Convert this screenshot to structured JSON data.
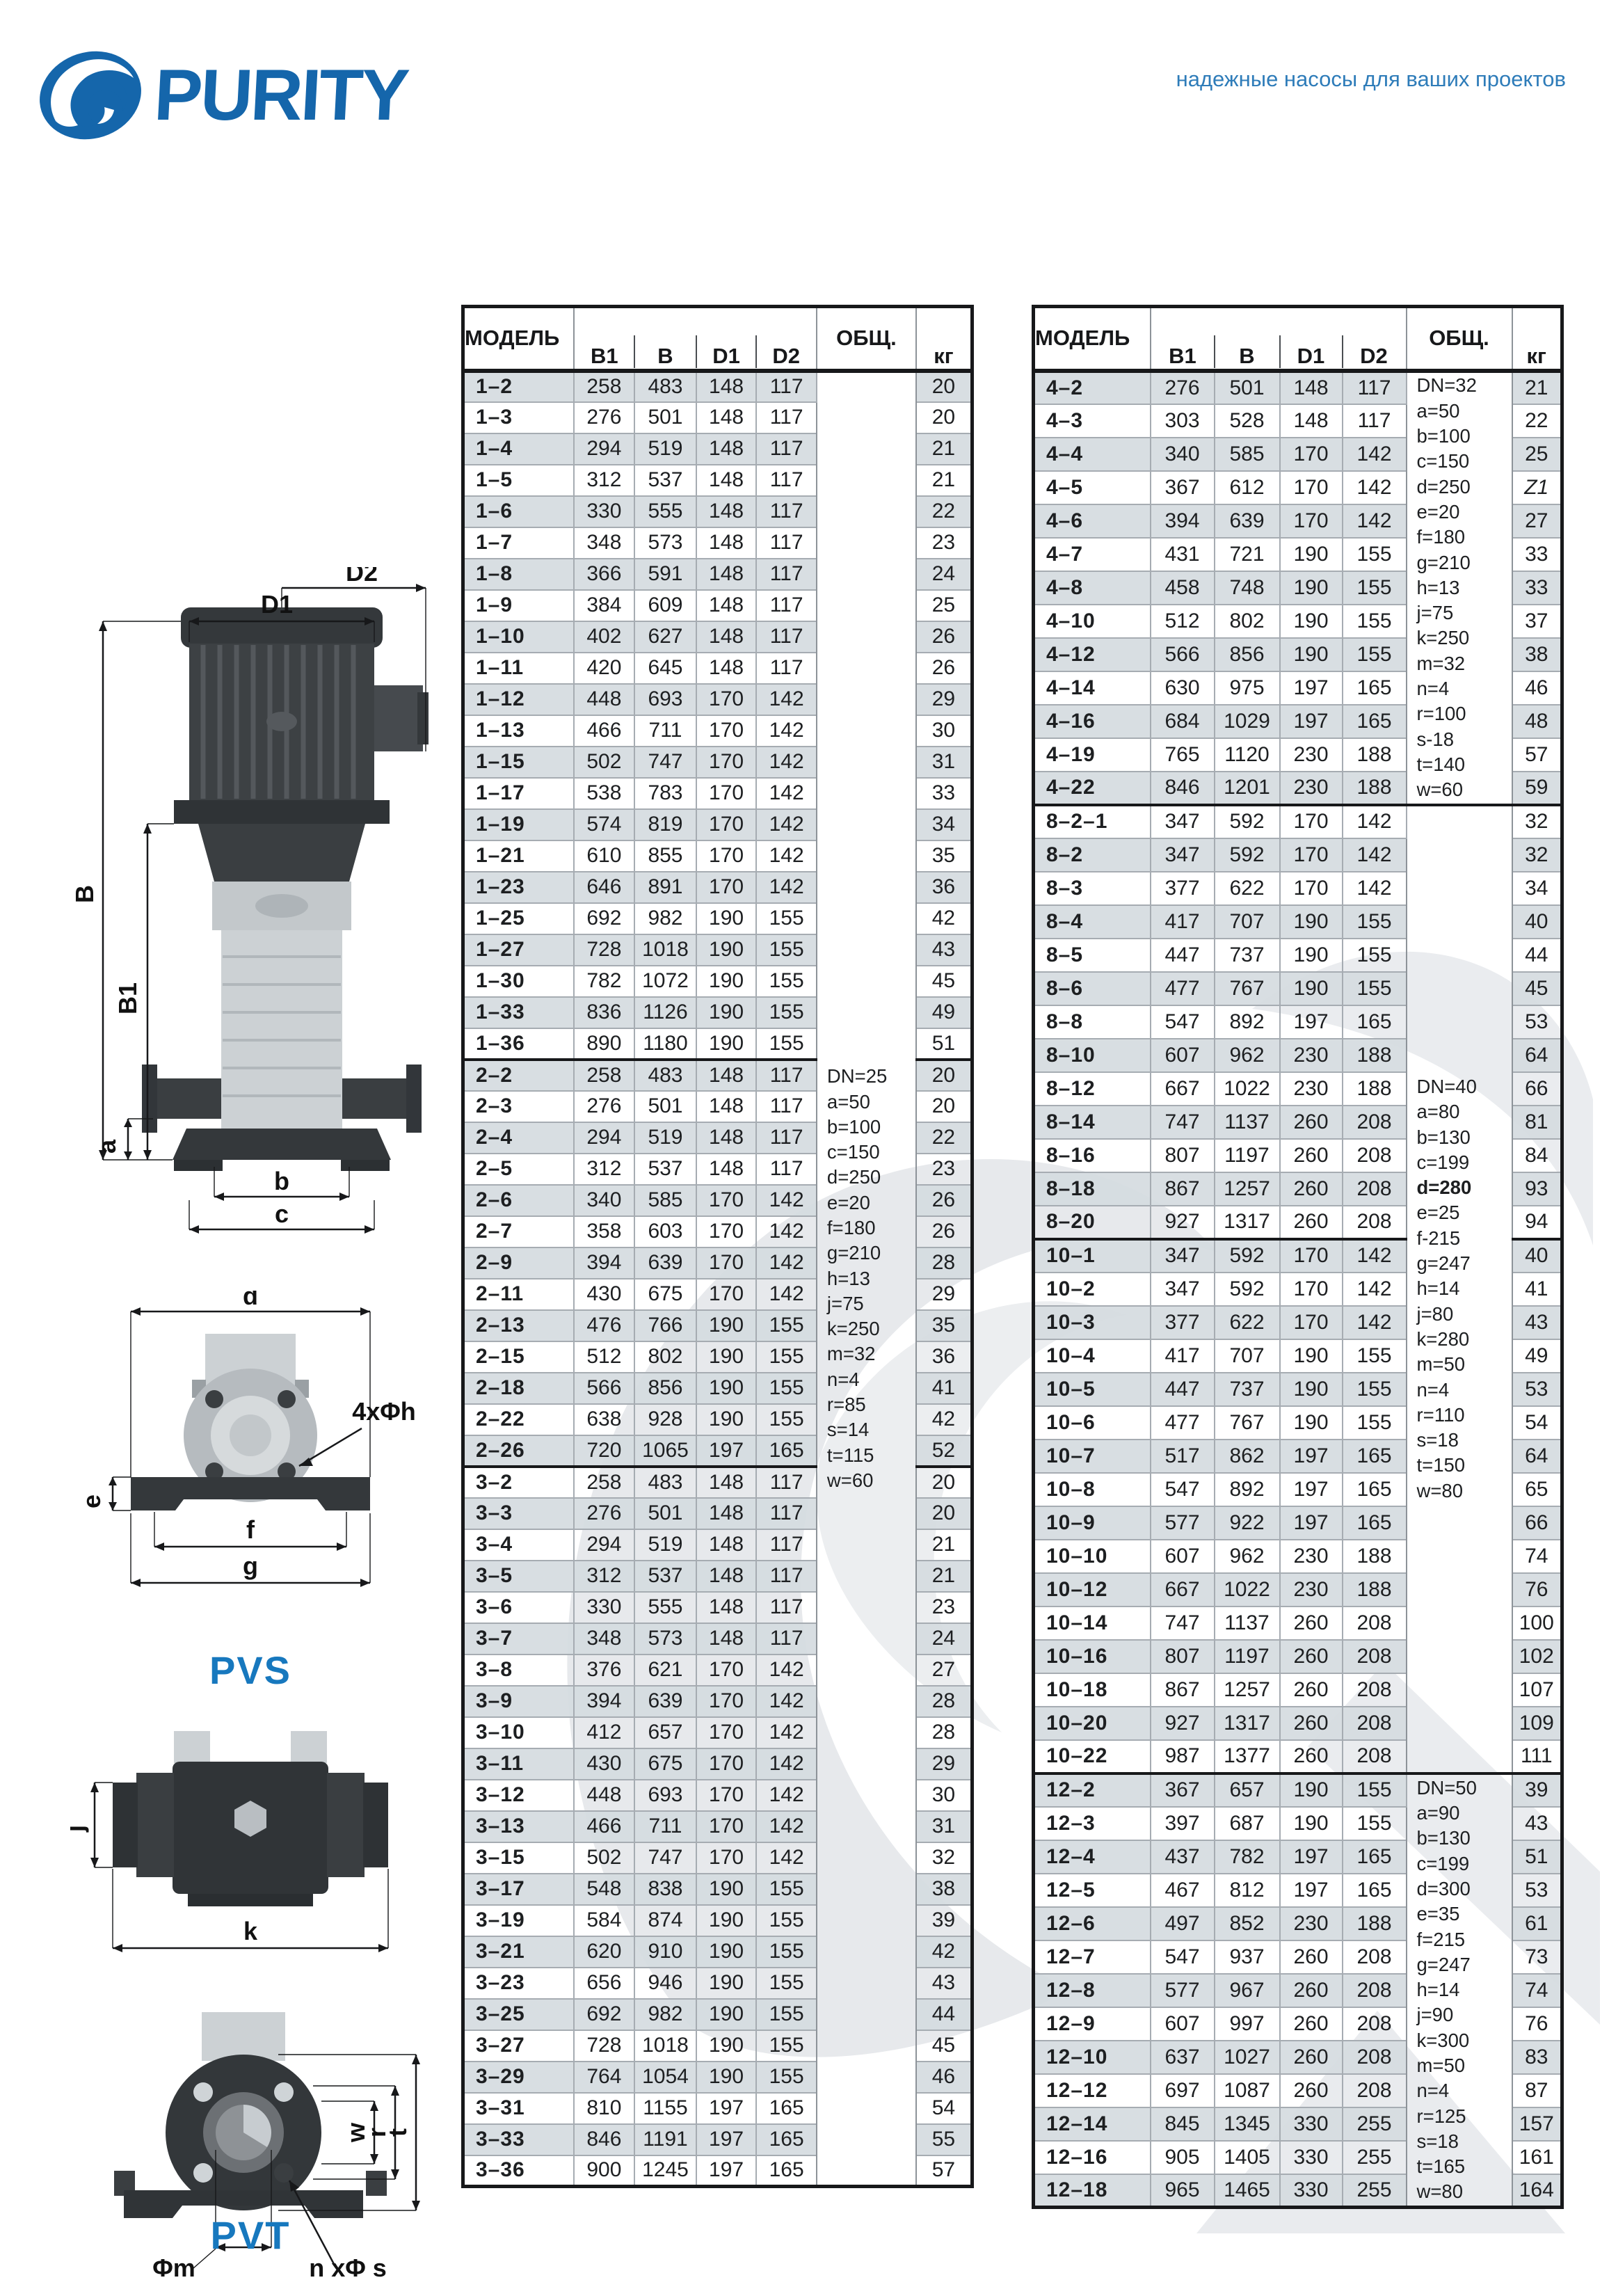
{
  "header": {
    "brand": "PURITY",
    "tagline": "надежные насосы для ваших проектов"
  },
  "colors": {
    "brand_blue": "#1566ab",
    "series_label_blue": "#1778be",
    "row_shade": "#d5dbe0"
  },
  "labels": {
    "pvs": "PVS",
    "pvt": "PVT",
    "dims": {
      "D1": "D1",
      "D2": "D2",
      "B": "B",
      "B1": "B1",
      "a": "a",
      "b": "b",
      "c": "c",
      "d": "d",
      "e": "e",
      "f": "f",
      "g": "g",
      "holes4": "4xΦh",
      "j": "j",
      "k": "k",
      "w": "w",
      "r": "r",
      "t": "t",
      "phim": "Φm",
      "nphis": "n xΦ s"
    }
  },
  "table_headers": {
    "model": "МОДЕЛЬ",
    "b1": "B1",
    "b": "B",
    "d1": "D1",
    "d2": "D2",
    "total": "ОБЩ.",
    "kg": "кг"
  },
  "left_table": {
    "group_start_indices": [
      22,
      35
    ],
    "notes_blocks": [
      {
        "start": 0,
        "span": 58,
        "bold": [],
        "lines": [
          "DN=25",
          "a=50",
          "b=100",
          "c=150",
          "d=250",
          "e=20",
          "f=180",
          "g=210",
          "h=13",
          "j=75",
          "k=250",
          "m=32",
          "n=4",
          "r=85",
          "s=14",
          "t=115",
          "w=60"
        ]
      }
    ],
    "rows": [
      [
        "1–2",
        258,
        483,
        148,
        117,
        20
      ],
      [
        "1–3",
        276,
        501,
        148,
        117,
        20
      ],
      [
        "1–4",
        294,
        519,
        148,
        117,
        21
      ],
      [
        "1–5",
        312,
        537,
        148,
        117,
        21
      ],
      [
        "1–6",
        330,
        555,
        148,
        117,
        22
      ],
      [
        "1–7",
        348,
        573,
        148,
        117,
        23
      ],
      [
        "1–8",
        366,
        591,
        148,
        117,
        24
      ],
      [
        "1–9",
        384,
        609,
        148,
        117,
        25
      ],
      [
        "1–10",
        402,
        627,
        148,
        117,
        26
      ],
      [
        "1–11",
        420,
        645,
        148,
        117,
        26
      ],
      [
        "1–12",
        448,
        693,
        170,
        142,
        29
      ],
      [
        "1–13",
        466,
        711,
        170,
        142,
        30
      ],
      [
        "1–15",
        502,
        747,
        170,
        142,
        31
      ],
      [
        "1–17",
        538,
        783,
        170,
        142,
        33
      ],
      [
        "1–19",
        574,
        819,
        170,
        142,
        34
      ],
      [
        "1–21",
        610,
        855,
        170,
        142,
        35
      ],
      [
        "1–23",
        646,
        891,
        170,
        142,
        36
      ],
      [
        "1–25",
        692,
        982,
        190,
        155,
        42
      ],
      [
        "1–27",
        728,
        1018,
        190,
        155,
        43
      ],
      [
        "1–30",
        782,
        1072,
        190,
        155,
        45
      ],
      [
        "1–33",
        836,
        1126,
        190,
        155,
        49
      ],
      [
        "1–36",
        890,
        1180,
        190,
        155,
        51
      ],
      [
        "2–2",
        258,
        483,
        148,
        117,
        20
      ],
      [
        "2–3",
        276,
        501,
        148,
        117,
        20
      ],
      [
        "2–4",
        294,
        519,
        148,
        117,
        22
      ],
      [
        "2–5",
        312,
        537,
        148,
        117,
        23
      ],
      [
        "2–6",
        340,
        585,
        170,
        142,
        26
      ],
      [
        "2–7",
        358,
        603,
        170,
        142,
        26
      ],
      [
        "2–9",
        394,
        639,
        170,
        142,
        28
      ],
      [
        "2–11",
        430,
        675,
        170,
        142,
        29
      ],
      [
        "2–13",
        476,
        766,
        190,
        155,
        35
      ],
      [
        "2–15",
        512,
        802,
        190,
        155,
        36
      ],
      [
        "2–18",
        566,
        856,
        190,
        155,
        41
      ],
      [
        "2–22",
        638,
        928,
        190,
        155,
        42
      ],
      [
        "2–26",
        720,
        1065,
        197,
        165,
        52
      ],
      [
        "3–2",
        258,
        483,
        148,
        117,
        20
      ],
      [
        "3–3",
        276,
        501,
        148,
        117,
        20
      ],
      [
        "3–4",
        294,
        519,
        148,
        117,
        21
      ],
      [
        "3–5",
        312,
        537,
        148,
        117,
        21
      ],
      [
        "3–6",
        330,
        555,
        148,
        117,
        23
      ],
      [
        "3–7",
        348,
        573,
        148,
        117,
        24
      ],
      [
        "3–8",
        376,
        621,
        170,
        142,
        27
      ],
      [
        "3–9",
        394,
        639,
        170,
        142,
        28
      ],
      [
        "3–10",
        412,
        657,
        170,
        142,
        28
      ],
      [
        "3–11",
        430,
        675,
        170,
        142,
        29
      ],
      [
        "3–12",
        448,
        693,
        170,
        142,
        30
      ],
      [
        "3–13",
        466,
        711,
        170,
        142,
        31
      ],
      [
        "3–15",
        502,
        747,
        170,
        142,
        32
      ],
      [
        "3–17",
        548,
        838,
        190,
        155,
        38
      ],
      [
        "3–19",
        584,
        874,
        190,
        155,
        39
      ],
      [
        "3–21",
        620,
        910,
        190,
        155,
        42
      ],
      [
        "3–23",
        656,
        946,
        190,
        155,
        43
      ],
      [
        "3–25",
        692,
        982,
        190,
        155,
        44
      ],
      [
        "3–27",
        728,
        1018,
        190,
        155,
        45
      ],
      [
        "3–29",
        764,
        1054,
        190,
        155,
        46
      ],
      [
        "3–31",
        810,
        1155,
        197,
        165,
        54
      ],
      [
        "3–33",
        846,
        1191,
        197,
        165,
        55
      ],
      [
        "3–36",
        900,
        1245,
        197,
        165,
        57
      ]
    ]
  },
  "right_table": {
    "group_start_indices": [
      13,
      26,
      42
    ],
    "notes_blocks": [
      {
        "start": 0,
        "span": 13,
        "bold": [],
        "lines": [
          "DN=32",
          "a=50",
          "b=100",
          "c=150",
          "d=250",
          "e=20",
          "f=180",
          "g=210",
          "h=13",
          "j=75",
          "k=250",
          "m=32",
          "n=4",
          "r=100",
          "s-18",
          "t=140",
          "w=60"
        ]
      },
      {
        "start": 13,
        "span": 29,
        "bold": [
          "d=280"
        ],
        "lines": [
          "DN=40",
          "a=80",
          "b=130",
          "c=199",
          "d=280",
          "e=25",
          "f-215",
          "g=247",
          "h=14",
          "j=80",
          "k=280",
          "m=50",
          "n=4",
          "r=110",
          "s=18",
          "t=150",
          "w=80"
        ]
      },
      {
        "start": 42,
        "span": 13,
        "bold": [],
        "lines": [
          "DN=50",
          "a=90",
          "b=130",
          "c=199",
          "d=300",
          "e=35",
          "f=215",
          "g=247",
          "h=14",
          "j=90",
          "k=300",
          "m=50",
          "n=4",
          "r=125",
          "s=18",
          "t=165",
          "w=80"
        ]
      }
    ],
    "rows": [
      [
        "4–2",
        276,
        501,
        148,
        117,
        21
      ],
      [
        "4–3",
        303,
        528,
        148,
        117,
        22
      ],
      [
        "4–4",
        340,
        585,
        170,
        142,
        25
      ],
      [
        "4–5",
        367,
        612,
        170,
        142,
        "Z1"
      ],
      [
        "4–6",
        394,
        639,
        170,
        142,
        27
      ],
      [
        "4–7",
        431,
        721,
        190,
        155,
        33
      ],
      [
        "4–8",
        458,
        748,
        190,
        155,
        33
      ],
      [
        "4–10",
        512,
        802,
        190,
        155,
        37
      ],
      [
        "4–12",
        566,
        856,
        190,
        155,
        38
      ],
      [
        "4–14",
        630,
        975,
        197,
        165,
        46
      ],
      [
        "4–16",
        684,
        1029,
        197,
        165,
        48
      ],
      [
        "4–19",
        765,
        1120,
        230,
        188,
        57
      ],
      [
        "4–22",
        846,
        1201,
        230,
        188,
        59
      ],
      [
        "8–2–1",
        347,
        592,
        170,
        142,
        32
      ],
      [
        "8–2",
        347,
        592,
        170,
        142,
        32
      ],
      [
        "8–3",
        377,
        622,
        170,
        142,
        34
      ],
      [
        "8–4",
        417,
        707,
        190,
        155,
        40
      ],
      [
        "8–5",
        447,
        737,
        190,
        155,
        44
      ],
      [
        "8–6",
        477,
        767,
        190,
        155,
        45
      ],
      [
        "8–8",
        547,
        892,
        197,
        165,
        53
      ],
      [
        "8–10",
        607,
        962,
        230,
        188,
        64
      ],
      [
        "8–12",
        667,
        1022,
        230,
        188,
        66
      ],
      [
        "8–14",
        747,
        1137,
        260,
        208,
        81
      ],
      [
        "8–16",
        807,
        1197,
        260,
        208,
        84
      ],
      [
        "8–18",
        867,
        1257,
        260,
        208,
        93
      ],
      [
        "8–20",
        927,
        1317,
        260,
        208,
        94
      ],
      [
        "10–1",
        347,
        592,
        170,
        142,
        40
      ],
      [
        "10–2",
        347,
        592,
        170,
        142,
        41
      ],
      [
        "10–3",
        377,
        622,
        170,
        142,
        43
      ],
      [
        "10–4",
        417,
        707,
        190,
        155,
        49
      ],
      [
        "10–5",
        447,
        737,
        190,
        155,
        53
      ],
      [
        "10–6",
        477,
        767,
        190,
        155,
        54
      ],
      [
        "10–7",
        517,
        862,
        197,
        165,
        64
      ],
      [
        "10–8",
        547,
        892,
        197,
        165,
        65
      ],
      [
        "10–9",
        577,
        922,
        197,
        165,
        66
      ],
      [
        "10–10",
        607,
        962,
        230,
        188,
        74
      ],
      [
        "10–12",
        667,
        1022,
        230,
        188,
        76
      ],
      [
        "10–14",
        747,
        1137,
        260,
        208,
        100
      ],
      [
        "10–16",
        807,
        1197,
        260,
        208,
        102
      ],
      [
        "10–18",
        867,
        1257,
        260,
        208,
        107
      ],
      [
        "10–20",
        927,
        1317,
        260,
        208,
        109
      ],
      [
        "10–22",
        987,
        1377,
        260,
        208,
        111
      ],
      [
        "12–2",
        367,
        657,
        190,
        155,
        39
      ],
      [
        "12–3",
        397,
        687,
        190,
        155,
        43
      ],
      [
        "12–4",
        437,
        782,
        197,
        165,
        51
      ],
      [
        "12–5",
        467,
        812,
        197,
        165,
        53
      ],
      [
        "12–6",
        497,
        852,
        230,
        188,
        61
      ],
      [
        "12–7",
        547,
        937,
        260,
        208,
        73
      ],
      [
        "12–8",
        577,
        967,
        260,
        208,
        74
      ],
      [
        "12–9",
        607,
        997,
        260,
        208,
        76
      ],
      [
        "12–10",
        637,
        1027,
        260,
        208,
        83
      ],
      [
        "12–12",
        697,
        1087,
        260,
        208,
        87
      ],
      [
        "12–14",
        845,
        1345,
        330,
        255,
        157
      ],
      [
        "12–16",
        905,
        1405,
        330,
        255,
        161
      ],
      [
        "12–18",
        965,
        1465,
        330,
        255,
        164
      ]
    ]
  }
}
